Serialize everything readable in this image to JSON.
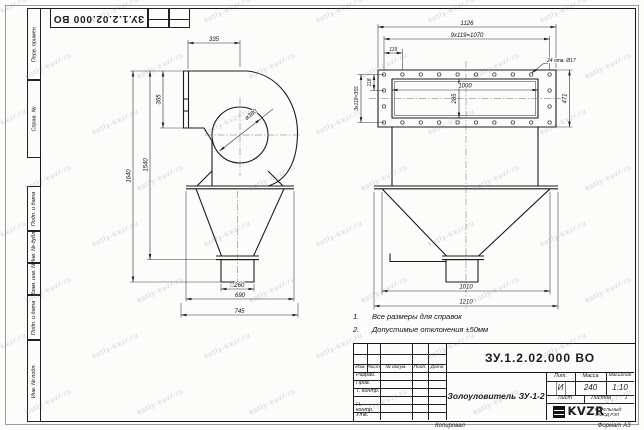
{
  "watermark": {
    "text": "kotly-kvzr.ru"
  },
  "sheet": {
    "top_doc_number": "ЗУ.1.2.02.000 ВО",
    "footer_copy": "Копировал",
    "footer_format": "Формат А3",
    "side_labels": [
      "Перв. примен.",
      "Справ. №",
      "Подп. и дата",
      "Инв. № дубл.",
      "Взам. инв. №",
      "Подп. и дата",
      "Инв. № подл."
    ]
  },
  "front_view": {
    "dim_335": "335",
    "dim_365": "365",
    "dim_1640": "1640",
    "dim_1540": "1540",
    "dia_380": "ø380",
    "dim_sq260": "□260",
    "dim_690": "690",
    "dim_745": "745"
  },
  "side_view": {
    "dim_1126": "1126",
    "dim_pitch": "9x119=1070",
    "dim_119": "119",
    "holes_note": "24 отв. Ø17",
    "dim_1000": "1000",
    "dim_285": "285",
    "dim_118": "118",
    "dim_col_pitch": "3x118=355",
    "dim_471": "471",
    "dim_1010": "1010",
    "dim_1210": "1210"
  },
  "notes": {
    "items": [
      {
        "num": "1.",
        "text": "Все размеры для справок"
      },
      {
        "num": "2.",
        "text": "Допустимые отклонения ±50мм"
      }
    ]
  },
  "title_block": {
    "doc_number": "ЗУ.1.2.02.000 ВО",
    "product_name": "Золоуловитель ЗУ-1-2",
    "col_headers": [
      "Изм.",
      "Лист",
      "№ докум.",
      "Подп.",
      "Дата"
    ],
    "row_labels": [
      "Разраб.",
      "Пров.",
      "Т. контр.",
      "",
      "Н. контр.",
      "Утв."
    ],
    "lit_header": "Лит.",
    "lit_value": "И",
    "mass_header": "Масса",
    "mass_value": "240",
    "scale_header": "Масштаб",
    "scale_value": "1:10",
    "sheet_header": "Лист",
    "sheets_header": "Листов",
    "sheets_value": "1",
    "logo_text": "KVZR",
    "company_line1": "КОТЕЛЬНЫЙ",
    "company_line2": "ЗАВОД РЭП"
  }
}
